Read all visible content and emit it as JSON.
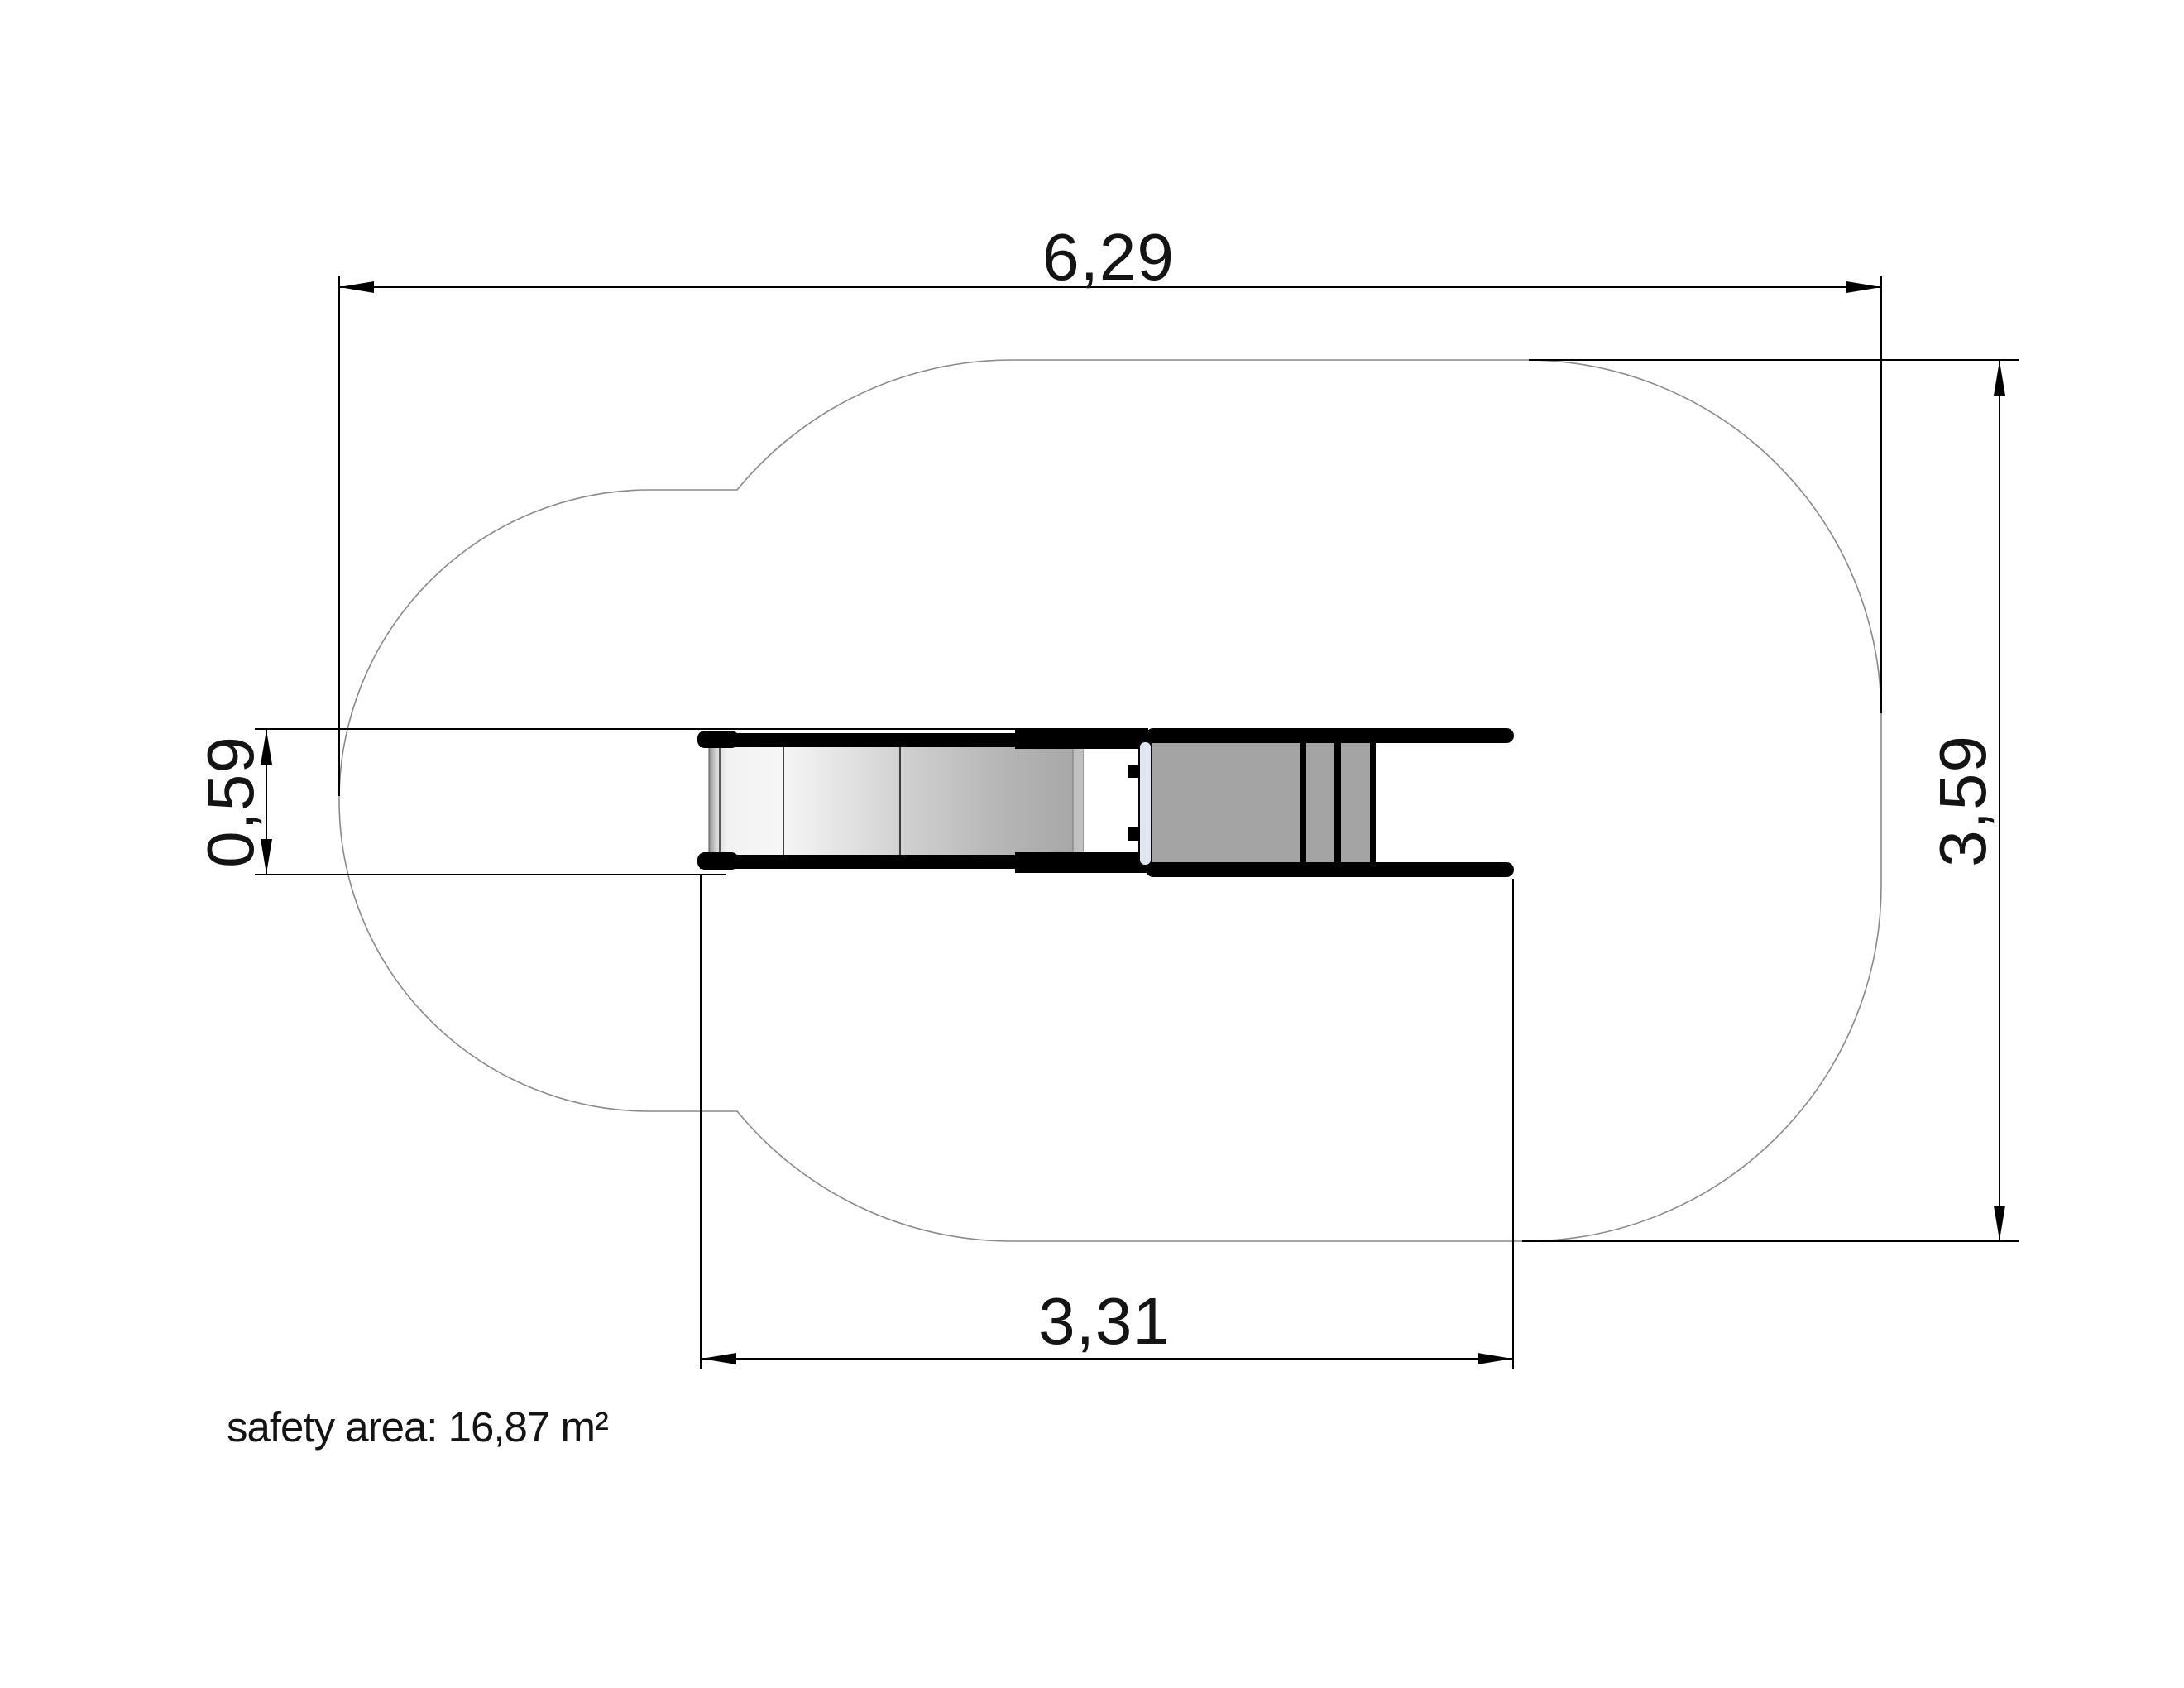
{
  "drawing": {
    "dimensions": {
      "total_width": {
        "value": "6,29",
        "meters": 6.29,
        "orientation": "horizontal",
        "position": "top"
      },
      "total_height": {
        "value": "3,59",
        "meters": 3.59,
        "orientation": "vertical",
        "position": "right"
      },
      "equipment_height": {
        "value": "0,59",
        "meters": 0.59,
        "orientation": "vertical",
        "position": "left"
      },
      "equipment_width": {
        "value": "3,31",
        "meters": 3.31,
        "orientation": "horizontal",
        "position": "bottom"
      }
    },
    "safety_area": {
      "text": "safety area: 16,87 m²",
      "value_m2": "16,87"
    },
    "colors": {
      "background": "#ffffff",
      "safety_outline": "#8a8a8a",
      "dimension_lines": "#000000",
      "equipment_frame": "#000000",
      "equipment_platform_gray": "#a4a4a4",
      "slide_strip_gray": "#c0c0c0",
      "junction_bar_blue": "#dfe6f2"
    }
  }
}
